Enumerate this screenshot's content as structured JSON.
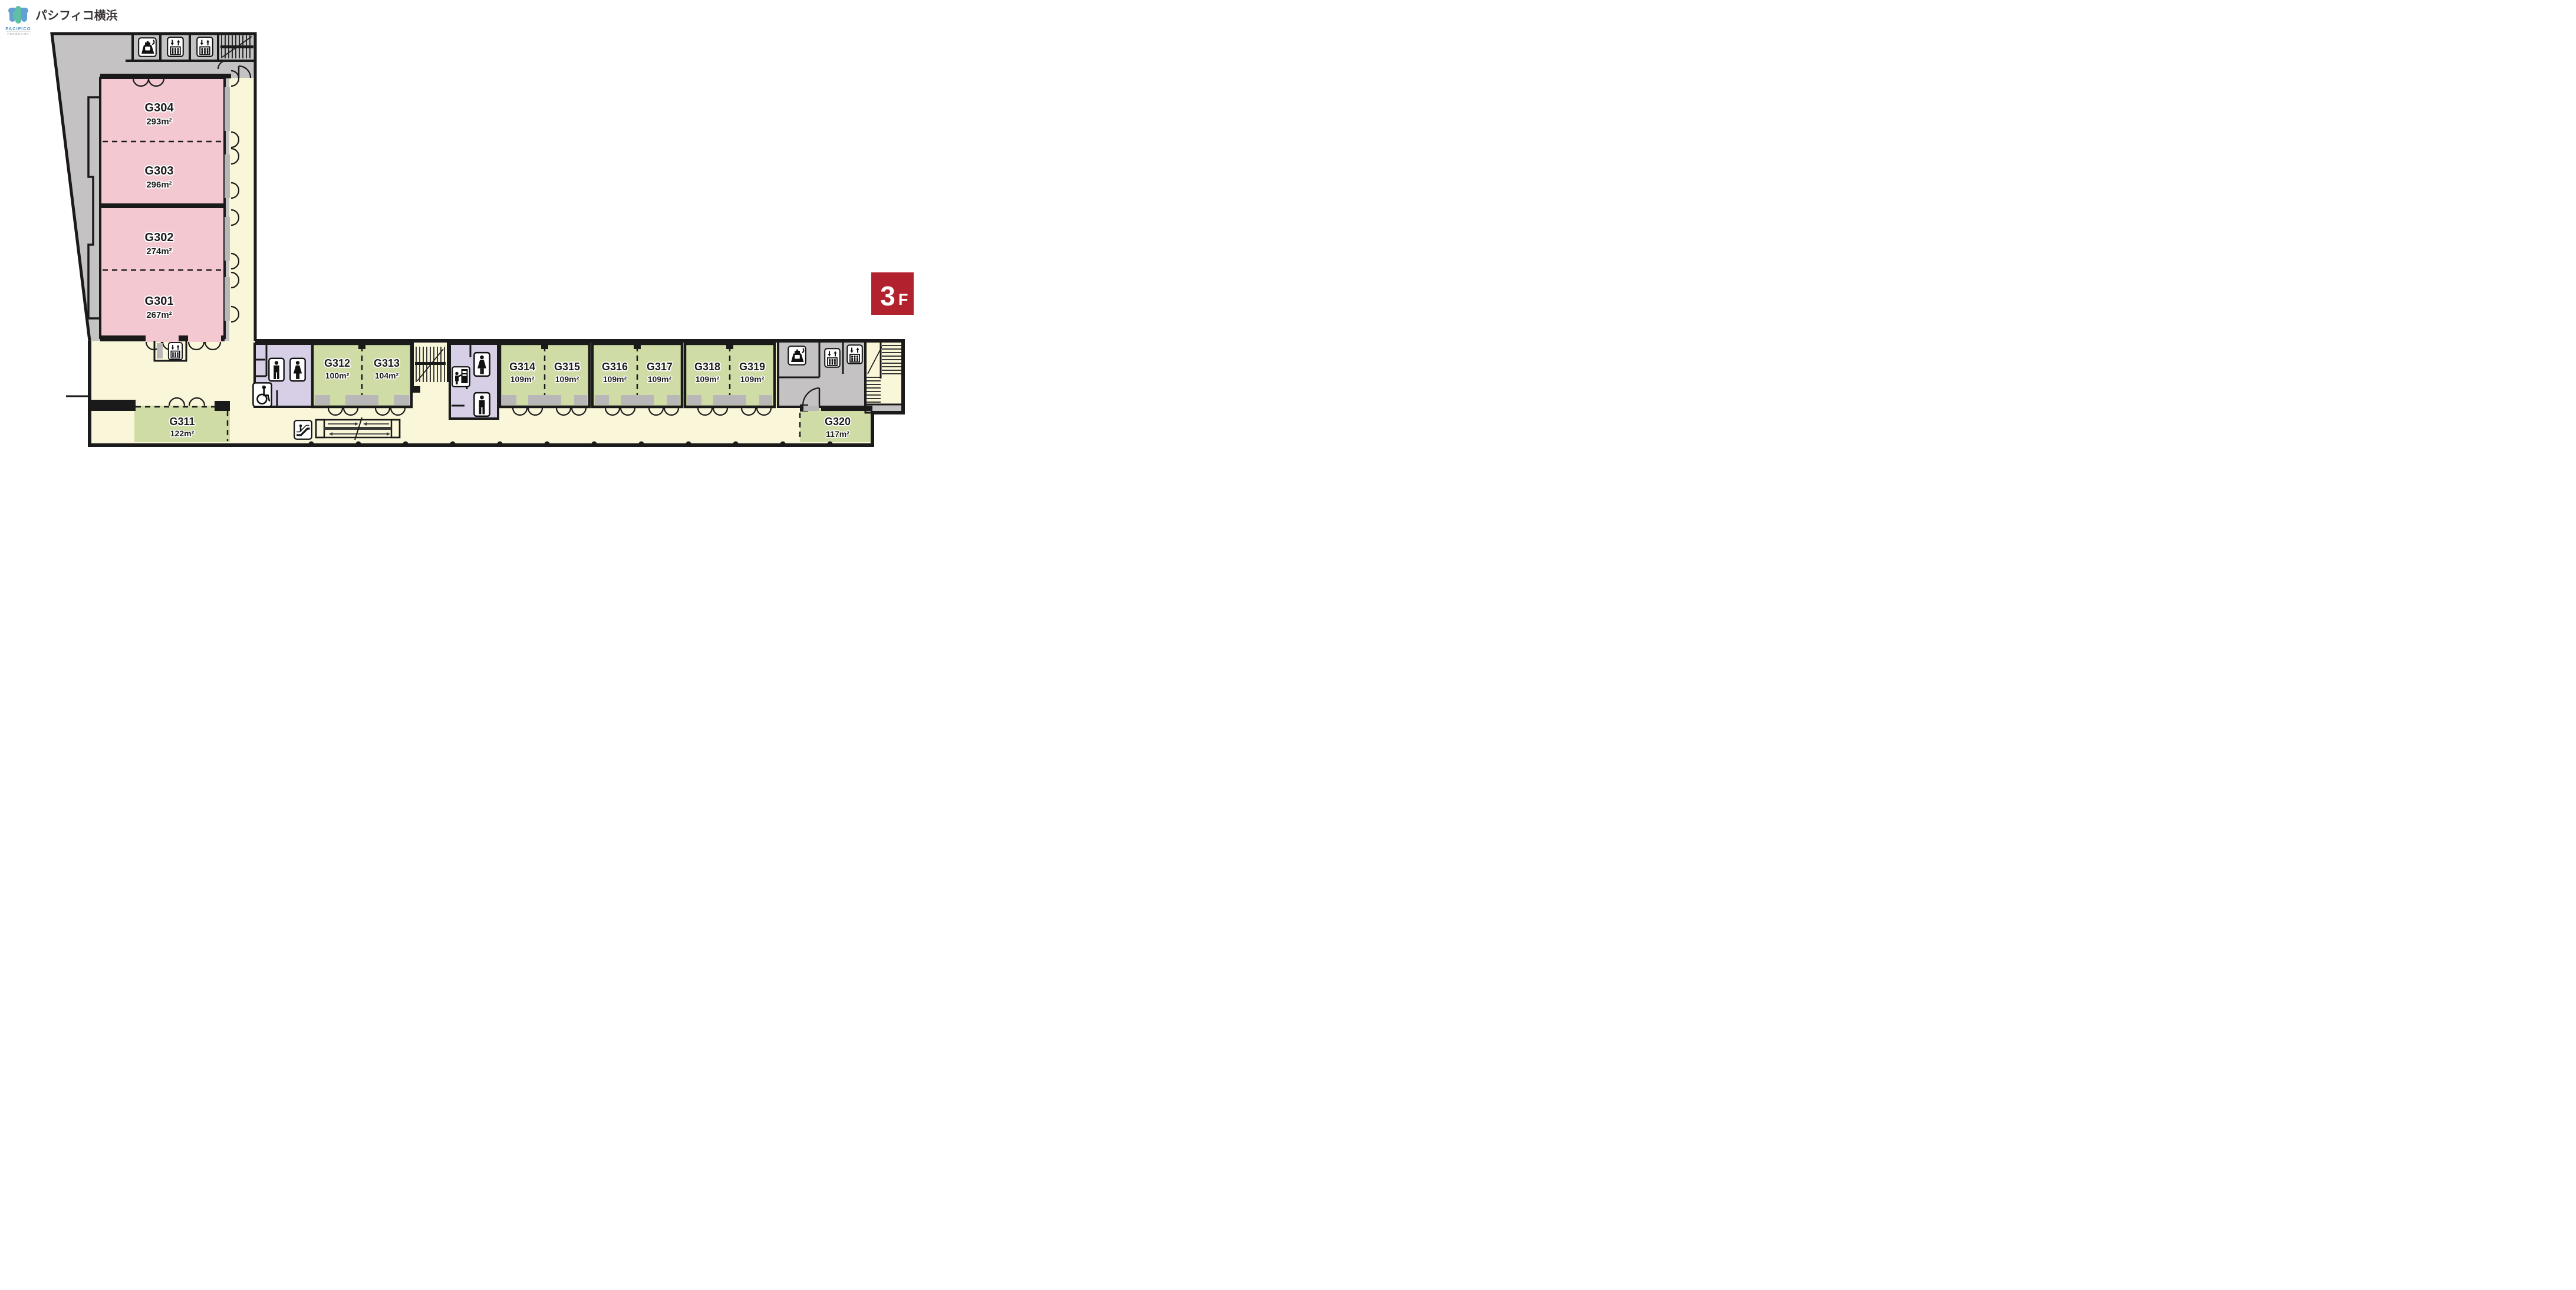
{
  "brand": {
    "logo_text_jp": "パシフィコ横浜",
    "logo_text_en": "PACIFICO",
    "logo_text_en_sub": "YOKOHAMA"
  },
  "floor_badge": {
    "floor": "3",
    "suffix": "F",
    "color": "#B1222E"
  },
  "rooms": {
    "G304": {
      "label": "G304",
      "area": "293m²",
      "color_key": "pink"
    },
    "G303": {
      "label": "G303",
      "area": "296m²",
      "color_key": "pink"
    },
    "G302": {
      "label": "G302",
      "area": "274m²",
      "color_key": "pink"
    },
    "G301": {
      "label": "G301",
      "area": "267m²",
      "color_key": "pink"
    },
    "G311": {
      "label": "G311",
      "area": "122m²",
      "color_key": "green"
    },
    "G312": {
      "label": "G312",
      "area": "100m²",
      "color_key": "green"
    },
    "G313": {
      "label": "G313",
      "area": "104m²",
      "color_key": "green"
    },
    "G314": {
      "label": "G314",
      "area": "109m²",
      "color_key": "green"
    },
    "G315": {
      "label": "G315",
      "area": "109m²",
      "color_key": "green"
    },
    "G316": {
      "label": "G316",
      "area": "109m²",
      "color_key": "green"
    },
    "G317": {
      "label": "G317",
      "area": "109m²",
      "color_key": "green"
    },
    "G318": {
      "label": "G318",
      "area": "109m²",
      "color_key": "green"
    },
    "G319": {
      "label": "G319",
      "area": "109m²",
      "color_key": "green"
    },
    "G320": {
      "label": "G320",
      "area": "117m²",
      "color_key": "green"
    }
  },
  "colors": {
    "room_pink": "#F3C8D1",
    "room_green": "#CFDCA6",
    "corridor_cream": "#FAF6D9",
    "toilet_purple": "#D6CFE5",
    "wall_gray": "#C4C2C3",
    "door_gray": "#B9B7B8",
    "wall_line": "#1a1a1a",
    "badge_red": "#B1222E",
    "logo_blue": "#62A0D0",
    "logo_green": "#5FBFA4"
  },
  "icons": {
    "elevator": "svg-symbol:#icon-elevator",
    "pantry": "svg-symbol:#icon-kettle",
    "male_toilet": "svg-symbol:#icon-male",
    "female_toilet": "svg-symbol:#icon-female",
    "accessible_toilet": "svg-symbol:#icon-wheelchair",
    "vending_machine": "svg-symbol:#icon-vending",
    "escalator": "svg-symbol:#icon-escalator"
  }
}
